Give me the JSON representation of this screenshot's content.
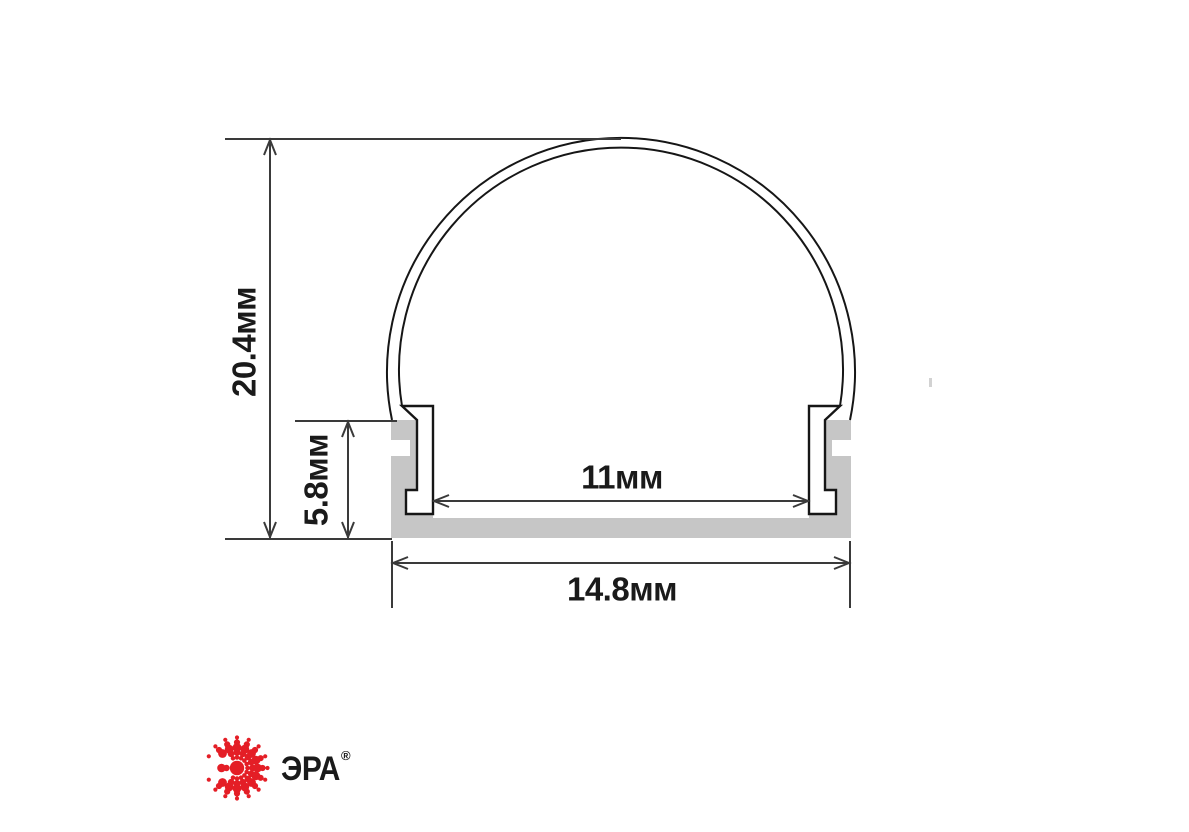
{
  "diagram": {
    "title_hint": "LED aluminium profile cross-section with dimensions",
    "dimensions": {
      "overall_height": "20.4мм",
      "base_height": "5.8мм",
      "inner_width": "11мм",
      "base_width": "14.8мм"
    }
  },
  "branding": {
    "logo_text": "ЭРА",
    "registered_mark": "®",
    "logo_color": "#e41e26"
  },
  "colors": {
    "background": "#ffffff",
    "aluminum_gray": "#c6c6c6",
    "outline_black": "#161616",
    "dimension_line": "#3a3a3a",
    "ink": "#1a1a1a",
    "artifact_gray": "#d2d2d2"
  }
}
